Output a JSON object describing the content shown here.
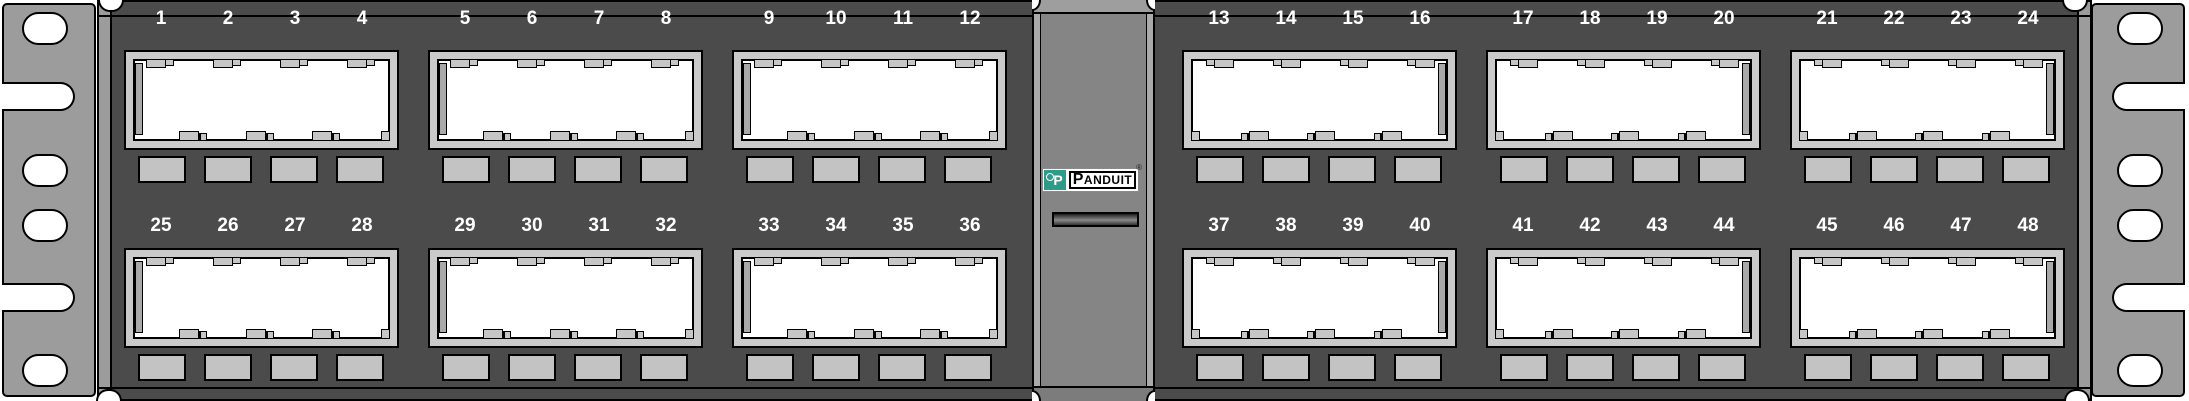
{
  "product": "48-port patch panel front view",
  "brand": {
    "mark_letter": "P",
    "name": "PANDUIT",
    "registered": "®"
  },
  "colors": {
    "panel": "#4b4b4b",
    "bracket": "#9c9c9c",
    "frame": "#cacaca",
    "tab": "#c6c6c6",
    "labelholder": "#c3c3c3",
    "divider": "#858585",
    "divideredge": "#aaaaaa",
    "teal": "#2d9b87",
    "numbertext": "#ffffff"
  },
  "rows": [
    {
      "groups": [
        {
          "ports": [
            "1",
            "2",
            "3",
            "4"
          ]
        },
        {
          "ports": [
            "5",
            "6",
            "7",
            "8"
          ]
        },
        {
          "ports": [
            "9",
            "10",
            "11",
            "12"
          ]
        },
        {
          "ports": [
            "13",
            "14",
            "15",
            "16"
          ]
        },
        {
          "ports": [
            "17",
            "18",
            "19",
            "20"
          ]
        },
        {
          "ports": [
            "21",
            "22",
            "23",
            "24"
          ]
        }
      ]
    },
    {
      "groups": [
        {
          "ports": [
            "25",
            "26",
            "27",
            "28"
          ]
        },
        {
          "ports": [
            "29",
            "30",
            "31",
            "32"
          ]
        },
        {
          "ports": [
            "33",
            "34",
            "35",
            "36"
          ]
        },
        {
          "ports": [
            "37",
            "38",
            "39",
            "40"
          ]
        },
        {
          "ports": [
            "41",
            "42",
            "43",
            "44"
          ]
        },
        {
          "ports": [
            "45",
            "46",
            "47",
            "48"
          ]
        }
      ]
    }
  ]
}
